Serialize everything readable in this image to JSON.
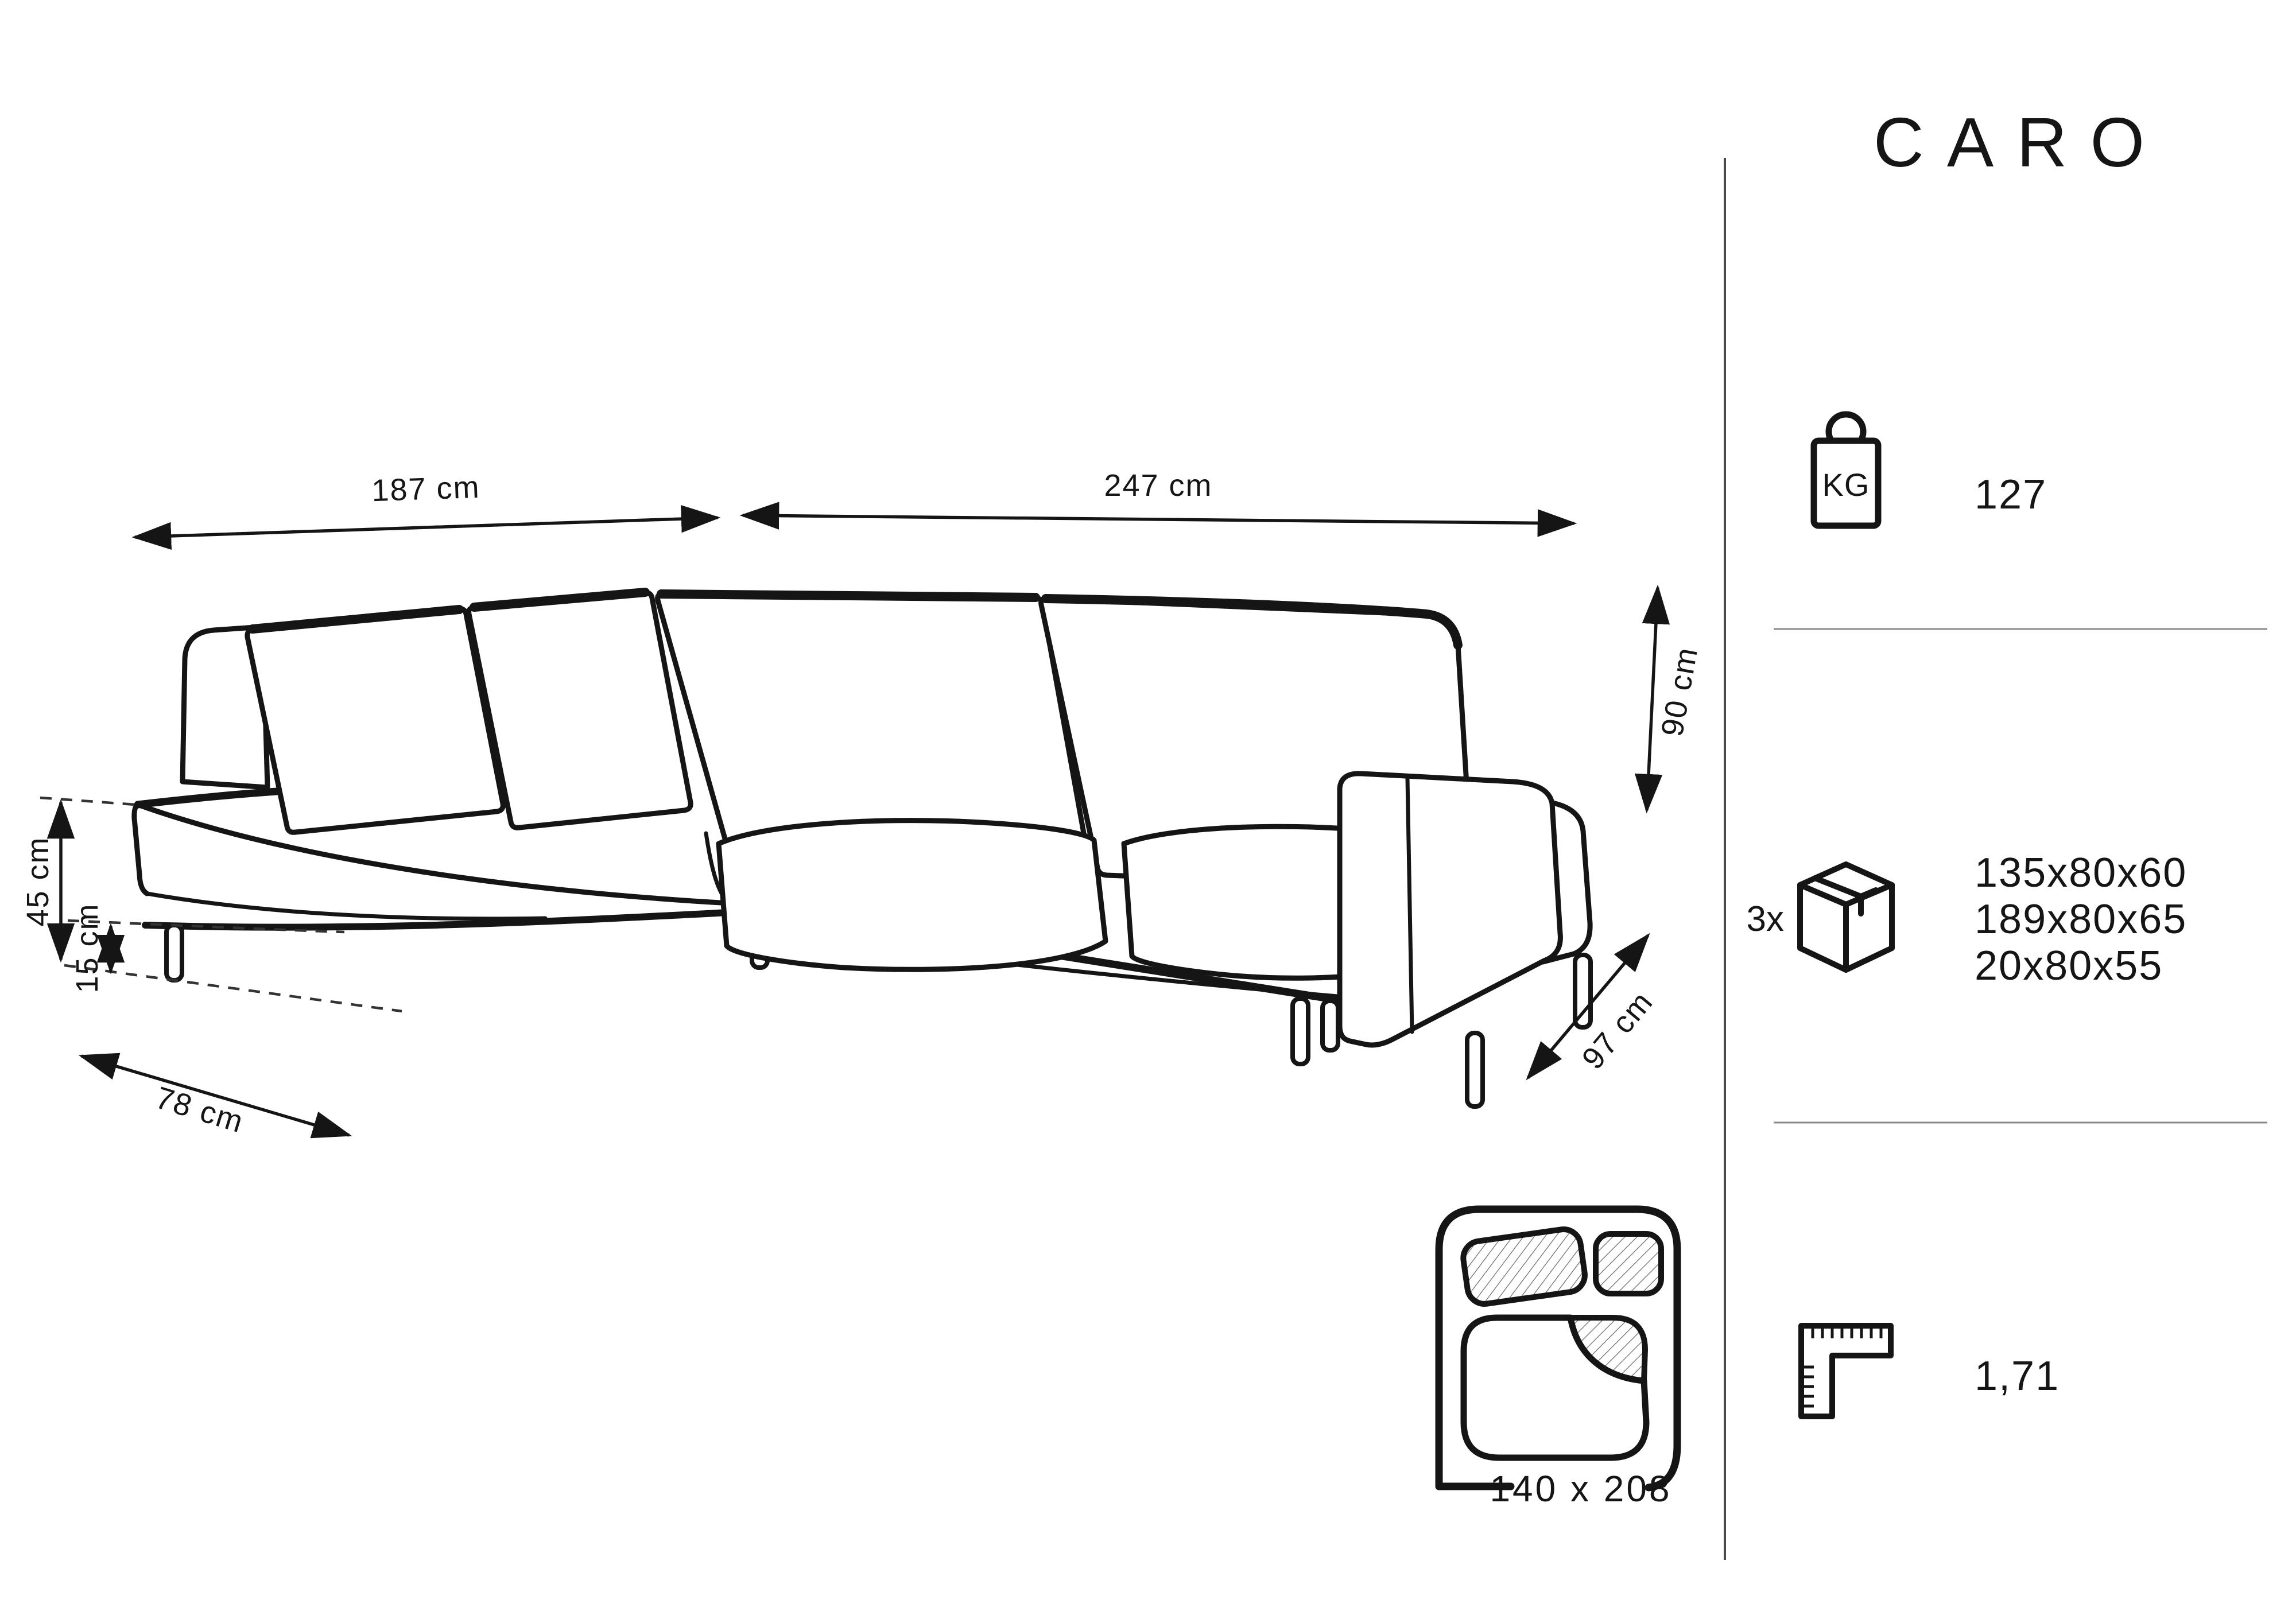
{
  "title": "CARO",
  "dimensions": {
    "back_width": "187 cm",
    "front_width": "247 cm",
    "height": "90 cm",
    "depth": "97 cm",
    "seat_height": "45 cm",
    "leg_height": "15 cm",
    "chaise_width": "78 cm"
  },
  "sleeping_area": {
    "size": "140 x 208"
  },
  "sidebar": {
    "weight": {
      "icon": "kg-weight-icon",
      "unit": "KG",
      "value": "127"
    },
    "packages": {
      "icon": "package-box-icon",
      "count": "3x",
      "sizes": [
        "135x80x60",
        "189x80x65",
        "20x80x55"
      ]
    },
    "volume": {
      "icon": "ruler-icon",
      "value": "1,71"
    }
  },
  "colors": {
    "line": "#151515",
    "divider": "#4a4a4a",
    "separator": "#8a8a8a",
    "background": "#ffffff"
  }
}
